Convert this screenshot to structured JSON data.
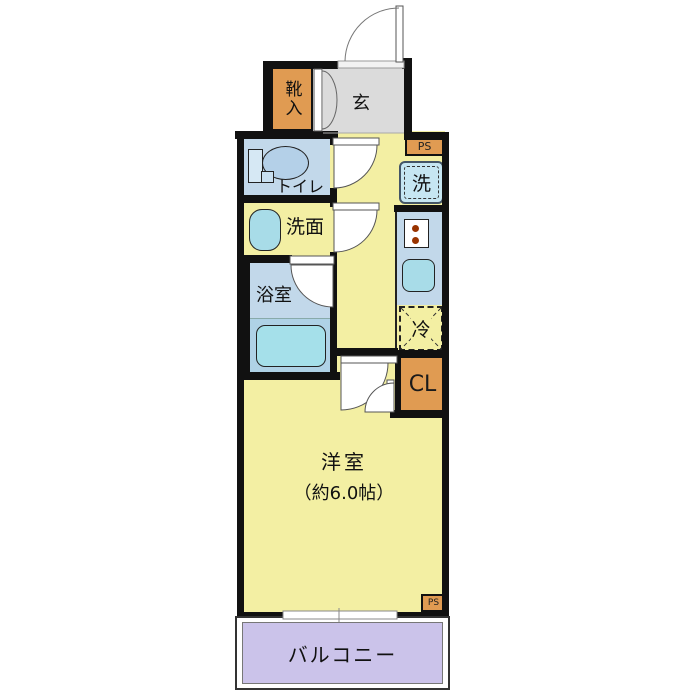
{
  "floorplan": {
    "type": "japanese-apartment-1K-floor-plan",
    "labels": {
      "entrance": "玄",
      "shoe_cabinet": "靴入",
      "toilet": "トイレ",
      "washroom": "洗面",
      "bathroom": "浴室",
      "washer": "洗",
      "refrigerator": "冷",
      "closet": "CL",
      "pipe_space_top": "PS",
      "pipe_space_bottom": "PS",
      "main_room_name": "洋室",
      "main_room_size": "（約6.0帖）",
      "balcony": "バルコニー"
    },
    "colors": {
      "wall": "#111111",
      "room_yellow": "#F3EFA3",
      "entrance_gray": "#DBDBDB",
      "water_blue": "#C2D8EA",
      "water_blue_dark": "#AFD2E6",
      "fixture_blue": "#A8DCE8",
      "tub_cyan": "#A5E0EA",
      "washer_blue": "#C6E6F2",
      "storage_orange": "#E09B52",
      "balcony_lavender": "#CBC3EA",
      "stove_dot_brown": "#993300"
    }
  }
}
